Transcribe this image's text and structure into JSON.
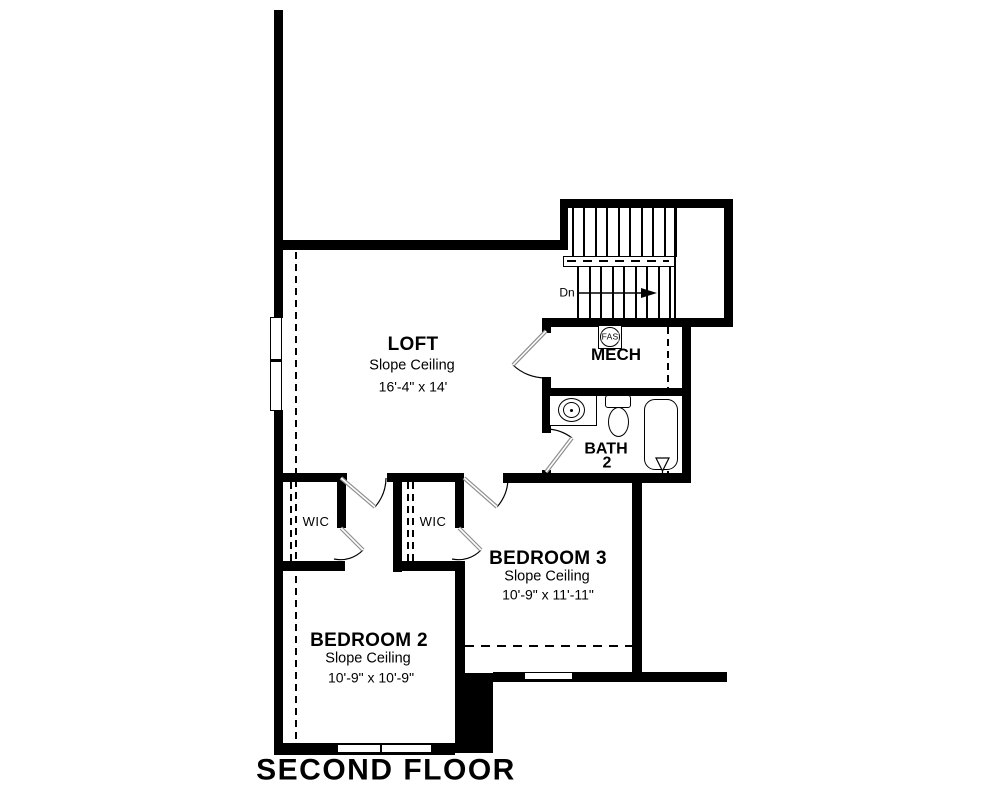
{
  "title": "SECOND FLOOR",
  "rooms": {
    "loft": {
      "name": "LOFT",
      "ceiling": "Slope Ceiling",
      "dims": "16'-4\" x 14'"
    },
    "mech": {
      "name": "MECH"
    },
    "bath": {
      "name": "BATH",
      "number": "2"
    },
    "bedroom3": {
      "name": "BEDROOM 3",
      "ceiling": "Slope Ceiling",
      "dims": "10'-9\" x 11'-11\""
    },
    "bedroom2": {
      "name": "BEDROOM 2",
      "ceiling": "Slope Ceiling",
      "dims": "10'-9\" x 10'-9\""
    },
    "wic_left": {
      "name": "WIC"
    },
    "wic_right": {
      "name": "WIC"
    }
  },
  "stairs": {
    "down_label": "Dn"
  },
  "equipment": {
    "furnace_label": "FAS"
  },
  "colors": {
    "wall": "#000000",
    "background": "#ffffff",
    "door_leaf": "#8f8f8f"
  }
}
